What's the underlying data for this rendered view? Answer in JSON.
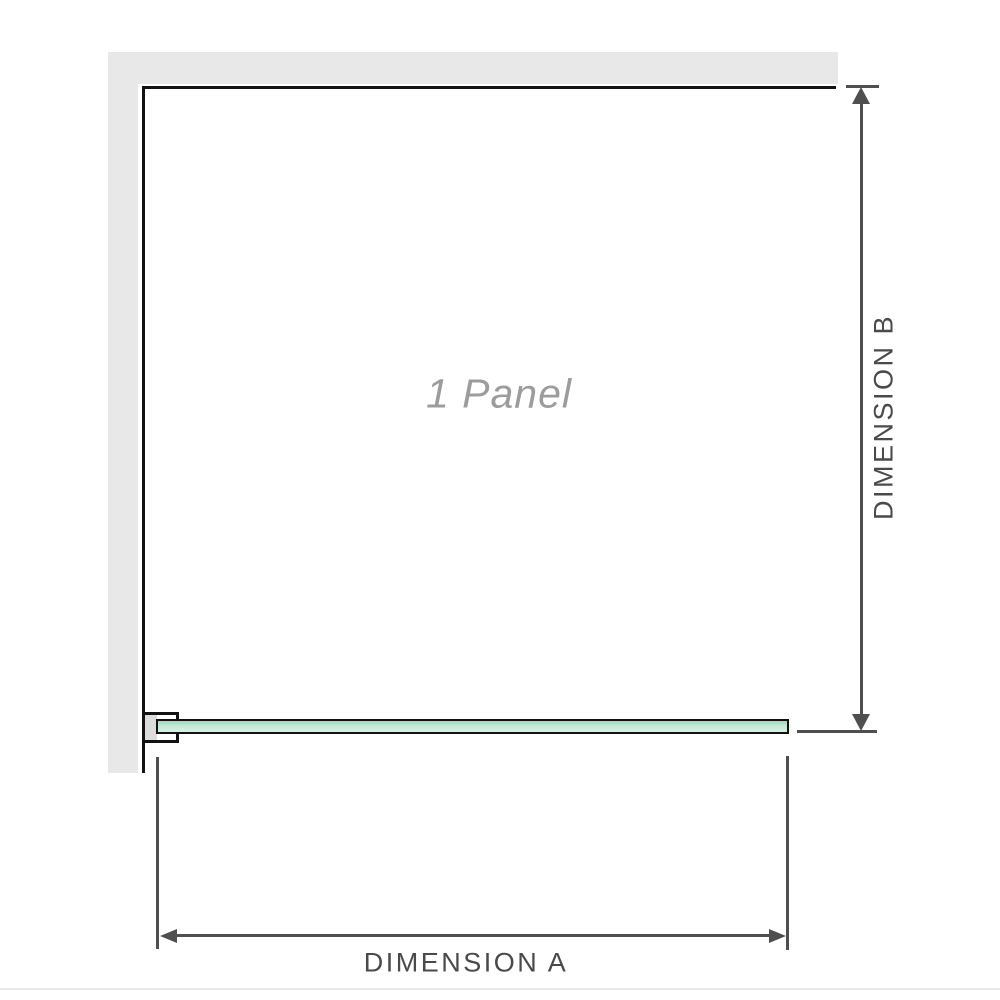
{
  "colors": {
    "wall": "#e8e8e8",
    "outline": "#121212",
    "dim": "#4f4f4f",
    "dim_text": "#4a4a4a",
    "glass_top": "#9fd8bb",
    "glass_mid": "#c3e9d5",
    "glass_bottom": "#d9f1e5",
    "panel_label": "#9c9c9c",
    "bracket_shim": "#dcdcdc",
    "edge_line": "#eae9e3"
  },
  "diagram": {
    "panel_label": "1 Panel",
    "dimension_a": {
      "label": "DIMENSION A"
    },
    "dimension_b": {
      "label": "DIMENSION B"
    }
  }
}
